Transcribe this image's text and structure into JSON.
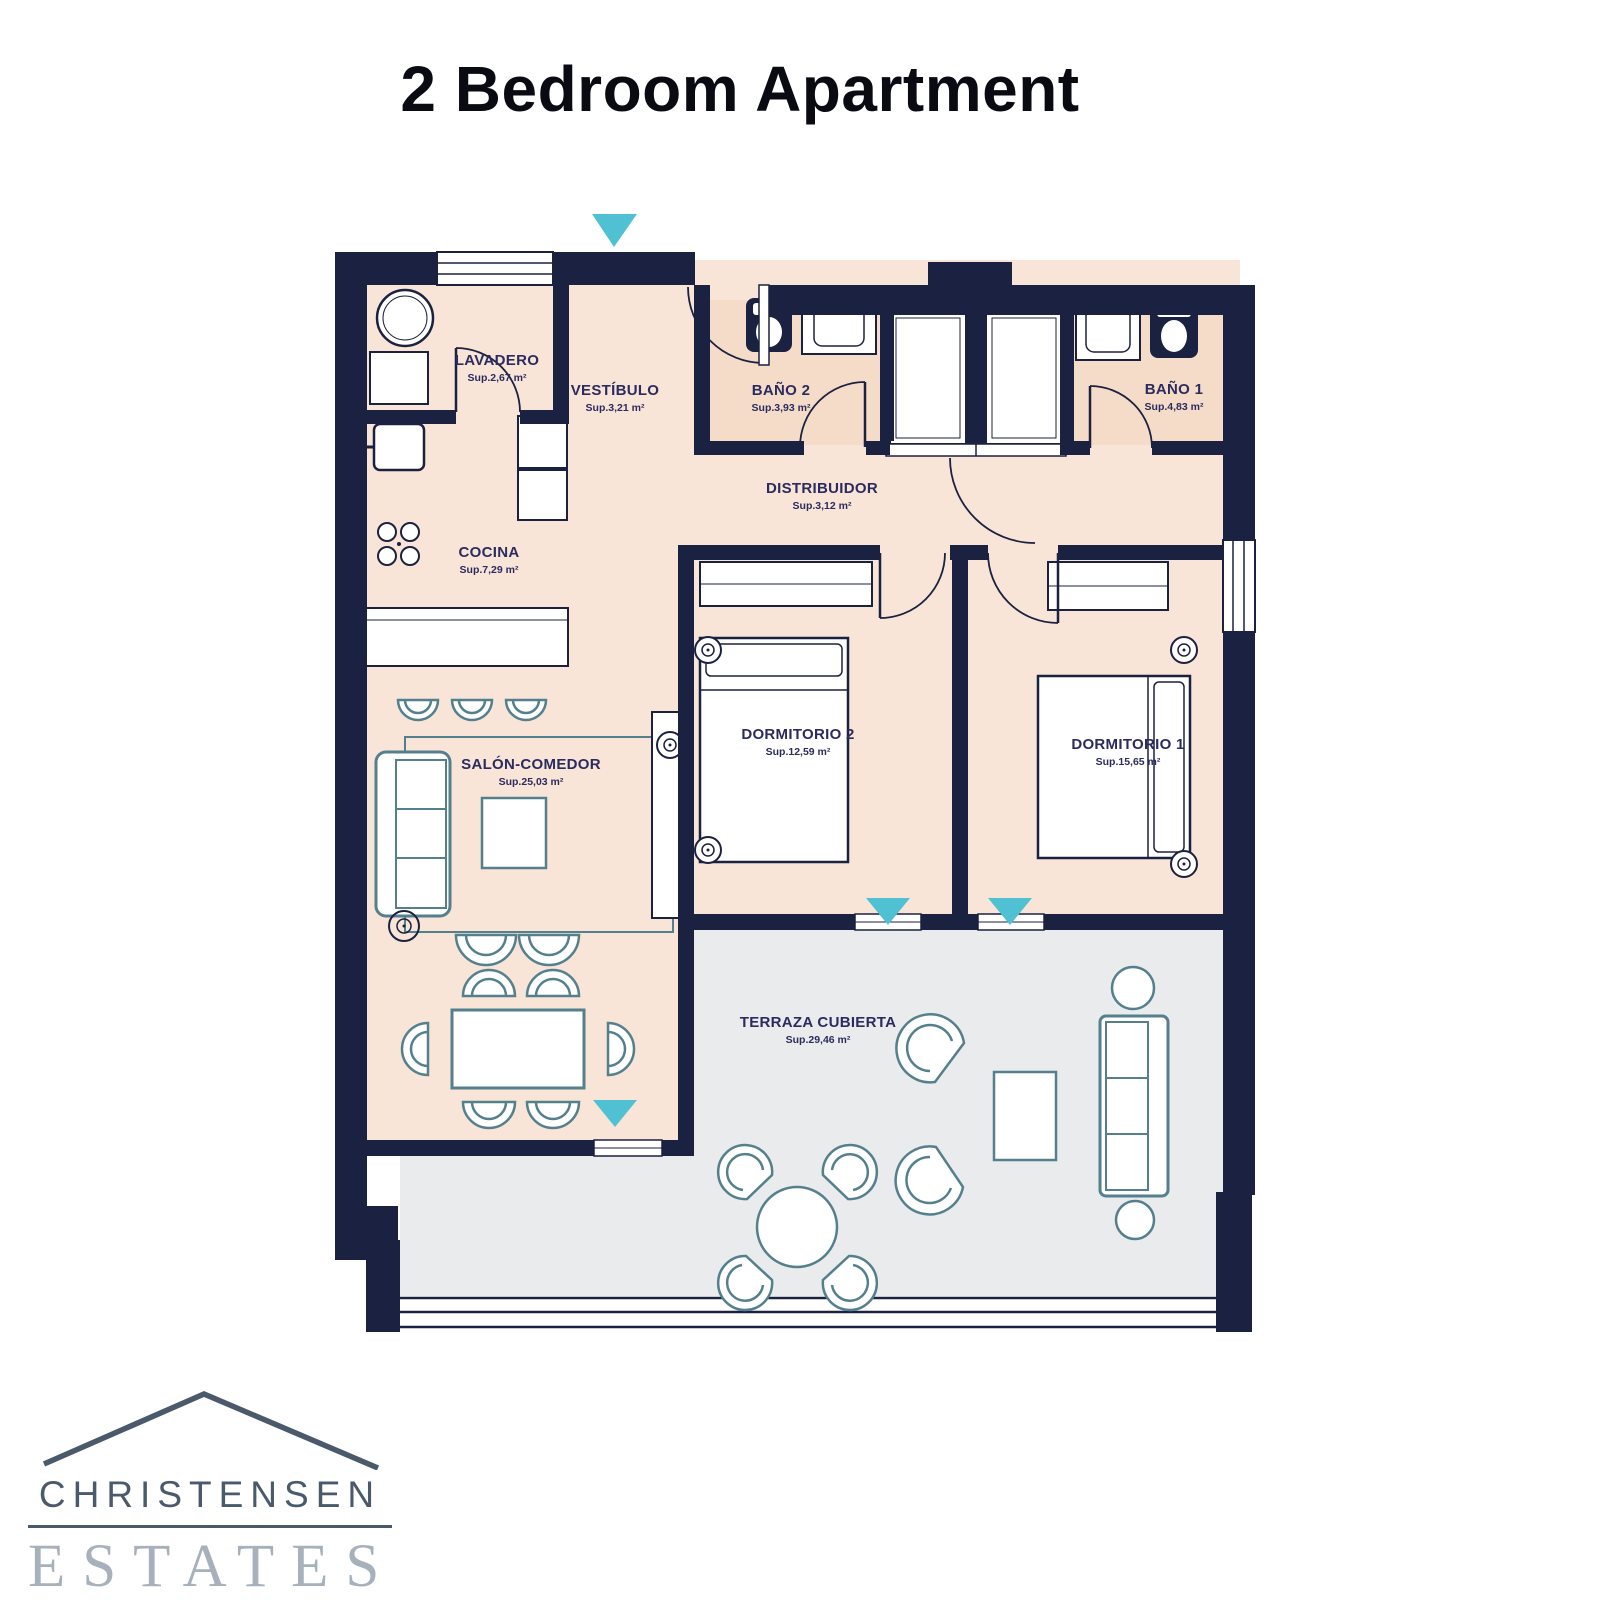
{
  "title": "2 Bedroom Apartment",
  "rooms": {
    "lavadero": {
      "label": "LAVADERO",
      "area": "Sup.2,67 m²"
    },
    "vestibulo": {
      "label": "VESTÍBULO",
      "area": "Sup.3,21 m²"
    },
    "bano2": {
      "label": "BAÑO 2",
      "area": "Sup.3,93 m²"
    },
    "bano1": {
      "label": "BAÑO 1",
      "area": "Sup.4,83 m²"
    },
    "distribuidor": {
      "label": "DISTRIBUIDOR",
      "area": "Sup.3,12 m²"
    },
    "cocina": {
      "label": "COCINA",
      "area": "Sup.7,29 m²"
    },
    "dormitorio2": {
      "label": "DORMITORIO 2",
      "area": "Sup.12,59 m²"
    },
    "dormitorio1": {
      "label": "DORMITORIO 1",
      "area": "Sup.15,65 m²"
    },
    "salon": {
      "label": "SALÓN-COMEDOR",
      "area": "Sup.25,03 m²"
    },
    "terraza": {
      "label": "TERRAZA CUBIERTA",
      "area": "Sup.29,46 m²"
    }
  },
  "logo": {
    "name": "CHRISTENSEN",
    "division": "ESTATES"
  },
  "colors": {
    "wall": "#1b2140",
    "room_fill": "#f8e5d7",
    "bath_fill": "#f4dcc9",
    "terrace_fill": "#e9ebed",
    "arrow_accent": "#4fc1d3",
    "furniture_stroke": "#54808e",
    "label_text": "#2b2b5e",
    "logo_primary": "#4a5a6b",
    "logo_secondary": "#a7b1bb"
  }
}
